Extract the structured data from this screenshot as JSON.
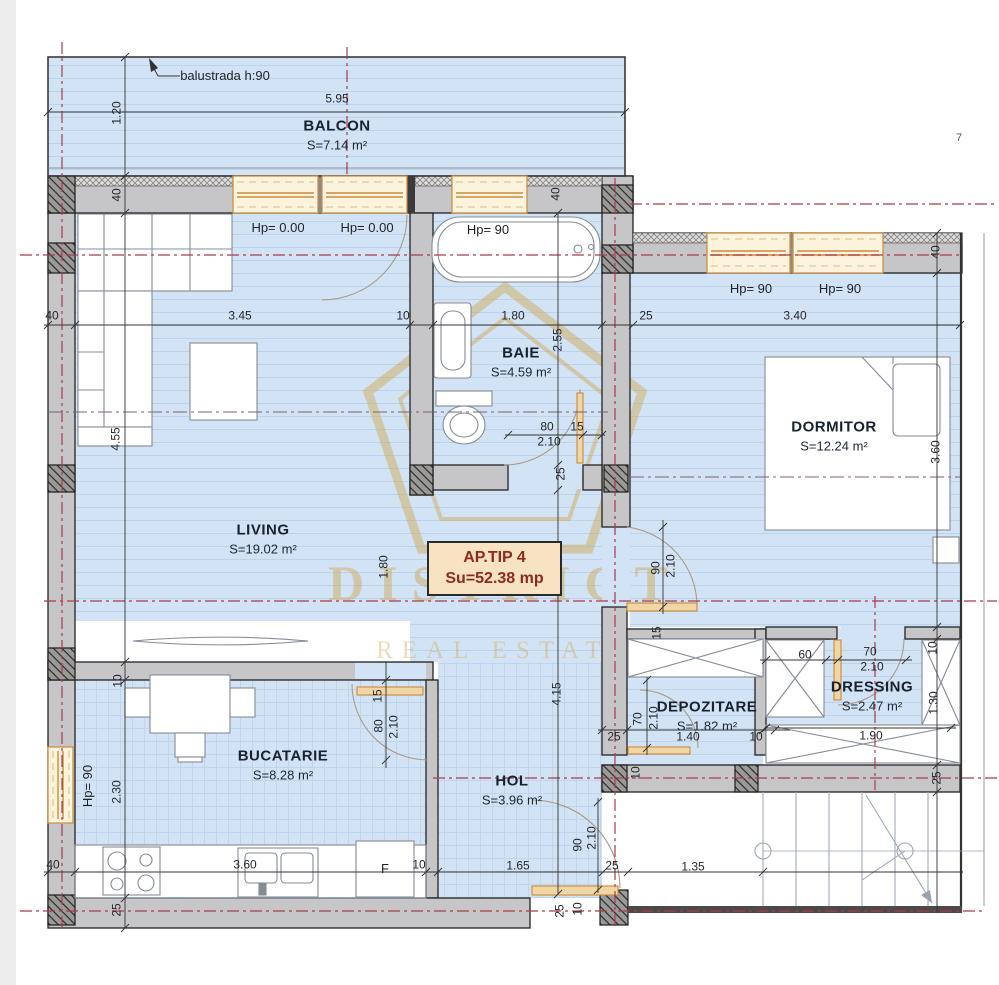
{
  "apartment": {
    "type_label": "AP.TIP 4",
    "area_label": "Su=52.38 mp"
  },
  "watermark": {
    "line1": "DISTRICT",
    "line2": "REAL ESTATE"
  },
  "rooms": [
    {
      "name": "BALCON",
      "area": "S=7.14 m²",
      "x": 337,
      "y": 135
    },
    {
      "name": "BAIE",
      "area": "S=4.59 m²",
      "x": 521,
      "y": 362
    },
    {
      "name": "DORMITOR",
      "area": "S=12.24 m²",
      "x": 834,
      "y": 436
    },
    {
      "name": "LIVING",
      "area": "S=19.02 m²",
      "x": 263,
      "y": 539
    },
    {
      "name": "DEPOZITARE",
      "area": "S=1.82 m²",
      "x": 707,
      "y": 716
    },
    {
      "name": "DRESSING",
      "area": "S=2.47 m²",
      "x": 872,
      "y": 696
    },
    {
      "name": "BUCATARIE",
      "area": "S=8.28 m²",
      "x": 283,
      "y": 765
    },
    {
      "name": "HOL",
      "area": "S=3.96 m²",
      "x": 512,
      "y": 790
    }
  ],
  "annotations": [
    {
      "t": "balustrada h:90",
      "x": 225,
      "y": 76
    },
    {
      "t": "Hp= 0.00",
      "x": 278,
      "y": 228
    },
    {
      "t": "Hp= 0.00",
      "x": 367,
      "y": 228
    },
    {
      "t": "Hp= 90",
      "x": 488,
      "y": 230
    },
    {
      "t": "Hp= 90",
      "x": 751,
      "y": 289
    },
    {
      "t": "Hp= 90",
      "x": 840,
      "y": 289
    },
    {
      "t": "Hp= 90",
      "x": 88,
      "y": 786,
      "r": 1
    },
    {
      "t": "F",
      "x": 385,
      "y": 869
    }
  ],
  "stray_marks": [
    {
      "t": "7",
      "x": 959,
      "y": 139
    }
  ],
  "dimensions": [
    {
      "t": "5.95",
      "x": 337,
      "y": 99
    },
    {
      "t": "1.20",
      "x": 117,
      "y": 113,
      "r": 1
    },
    {
      "t": "40",
      "x": 117,
      "y": 195,
      "r": 1
    },
    {
      "t": "40",
      "x": 556,
      "y": 194,
      "r": 1
    },
    {
      "t": "40",
      "x": 936,
      "y": 252,
      "r": 1
    },
    {
      "t": "40",
      "x": 52,
      "y": 316
    },
    {
      "t": "3.45",
      "x": 240,
      "y": 316
    },
    {
      "t": "10",
      "x": 403,
      "y": 316
    },
    {
      "t": "1.80",
      "x": 513,
      "y": 316
    },
    {
      "t": "25",
      "x": 646,
      "y": 316
    },
    {
      "t": "3.40",
      "x": 795,
      "y": 316
    },
    {
      "t": "2.55",
      "x": 558,
      "y": 340,
      "r": 1
    },
    {
      "t": "3.60",
      "x": 936,
      "y": 452,
      "r": 1
    },
    {
      "t": "4.55",
      "x": 116,
      "y": 439,
      "r": 1
    },
    {
      "t": "80",
      "x": 547,
      "y": 427
    },
    {
      "t": "15",
      "x": 577,
      "y": 427
    },
    {
      "t": "2.10",
      "x": 549,
      "y": 442
    },
    {
      "t": "25",
      "x": 561,
      "y": 474,
      "r": 1
    },
    {
      "t": "1.80",
      "x": 384,
      "y": 567,
      "r": 1
    },
    {
      "t": "90",
      "x": 656,
      "y": 568,
      "r": 1
    },
    {
      "t": "2.10",
      "x": 671,
      "y": 566,
      "r": 1
    },
    {
      "t": "15",
      "x": 657,
      "y": 633,
      "r": 1
    },
    {
      "t": "10",
      "x": 933,
      "y": 648,
      "r": 1
    },
    {
      "t": "60",
      "x": 805,
      "y": 655
    },
    {
      "t": "70",
      "x": 870,
      "y": 652
    },
    {
      "t": "2.10",
      "x": 872,
      "y": 667
    },
    {
      "t": "1.30",
      "x": 934,
      "y": 703,
      "r": 1
    },
    {
      "t": "70",
      "x": 638,
      "y": 719,
      "r": 1
    },
    {
      "t": "2.10",
      "x": 654,
      "y": 718,
      "r": 1
    },
    {
      "t": "25",
      "x": 614,
      "y": 737
    },
    {
      "t": "1.40",
      "x": 688,
      "y": 737
    },
    {
      "t": "10",
      "x": 756,
      "y": 737
    },
    {
      "t": "1.90",
      "x": 871,
      "y": 736
    },
    {
      "t": "10",
      "x": 636,
      "y": 773,
      "r": 1
    },
    {
      "t": "25",
      "x": 937,
      "y": 778,
      "r": 1
    },
    {
      "t": "4.15",
      "x": 557,
      "y": 694,
      "r": 1
    },
    {
      "t": "15",
      "x": 378,
      "y": 696,
      "r": 1
    },
    {
      "t": "80",
      "x": 379,
      "y": 726,
      "r": 1
    },
    {
      "t": "2.10",
      "x": 394,
      "y": 727,
      "r": 1
    },
    {
      "t": "10",
      "x": 118,
      "y": 681,
      "r": 1
    },
    {
      "t": "2.30",
      "x": 117,
      "y": 792,
      "r": 1
    },
    {
      "t": "90",
      "x": 578,
      "y": 845,
      "r": 1
    },
    {
      "t": "2.10",
      "x": 592,
      "y": 838,
      "r": 1
    },
    {
      "t": "40",
      "x": 53,
      "y": 865
    },
    {
      "t": "3.60",
      "x": 245,
      "y": 865
    },
    {
      "t": "10",
      "x": 419,
      "y": 865
    },
    {
      "t": "1.65",
      "x": 518,
      "y": 866
    },
    {
      "t": "25",
      "x": 612,
      "y": 866
    },
    {
      "t": "1.35",
      "x": 693,
      "y": 867
    },
    {
      "t": "25",
      "x": 117,
      "y": 910,
      "r": 1
    },
    {
      "t": "25",
      "x": 560,
      "y": 911,
      "r": 1
    },
    {
      "t": "10",
      "x": 578,
      "y": 909,
      "r": 1
    }
  ],
  "colors": {
    "floor": "#d2e3f5",
    "floor_stripe": "#bcd3ea",
    "wall": "#c6c6c8",
    "window_frame": "#c98a3c",
    "window_glass": "#fcf3dd",
    "axis_red": "#a73c4c",
    "axis_purple": "#7c6070",
    "watermark_gold": "#cfab5e",
    "apbox_bg": "#f7e3c2",
    "apbox_text": "#8e2b1c"
  }
}
